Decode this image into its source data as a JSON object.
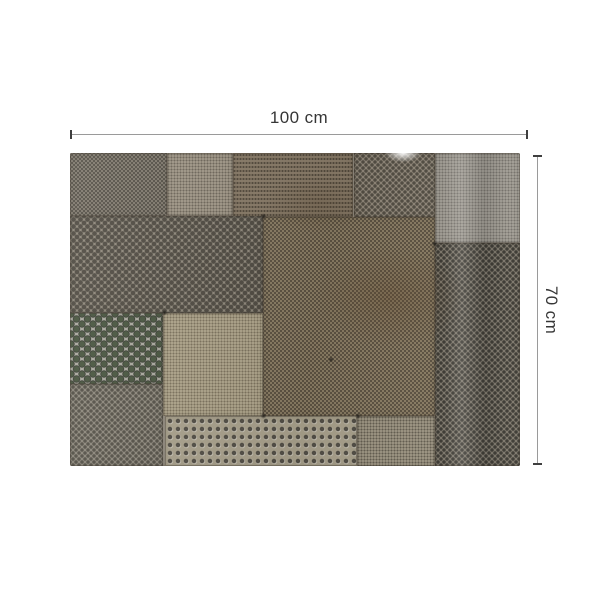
{
  "page": {
    "background_color": "#ffffff"
  },
  "dimension_annotations": {
    "width": {
      "label": "100 cm"
    },
    "height": {
      "label": "70 cm"
    },
    "line_color": "#9a9a9a",
    "tick_color": "#3f3f3f",
    "label_color": "#363636"
  },
  "photo": {
    "alt": "Top-down photo of a rectangular patchwork of weathered perforated metal sheets with assorted hole sizes and patterns in grey, tan and brown tones",
    "panels": [
      {
        "name": "panel-top-left-mesh",
        "x": 0,
        "y": 0,
        "w": 21.6,
        "h": 20.1,
        "base": "#8b8478",
        "dot": "rgba(42,39,33,0.55)",
        "pattern": "mesh"
      },
      {
        "name": "panel-top-tan-fine",
        "x": 21.6,
        "y": 0,
        "w": 14.7,
        "h": 20.1,
        "base": "#a69d8d",
        "dot": "rgba(55,50,42,0.50)",
        "pattern": "fine"
      },
      {
        "name": "panel-top-brown-dash",
        "x": 36.3,
        "y": 0,
        "w": 26.7,
        "h": 20.4,
        "base": "#8a7c69",
        "dot": "rgba(40,34,26,0.55)",
        "pattern": "dash"
      },
      {
        "name": "panel-top-polka",
        "x": 63.0,
        "y": 0,
        "w": 18.2,
        "h": 20.4,
        "base": "#92897b",
        "dot": "rgba(44,40,33,0.60)",
        "pattern": "med"
      },
      {
        "name": "panel-top-right-grey",
        "x": 81.2,
        "y": 0,
        "w": 18.8,
        "h": 28.8,
        "base": "#a7a39a",
        "dot": "rgba(60,58,52,0.45)",
        "pattern": "fine"
      },
      {
        "name": "panel-mid-left-coarse",
        "x": 0,
        "y": 20.1,
        "w": 42.9,
        "h": 31.0,
        "base": "#90897c",
        "dot": "rgba(38,35,29,0.60)",
        "pattern": "coarse"
      },
      {
        "name": "panel-center-mesh",
        "x": 42.9,
        "y": 20.4,
        "w": 38.2,
        "h": 63.6,
        "base": "#97886e",
        "dot": "rgba(43,37,28,0.55)",
        "pattern": "mesh"
      },
      {
        "name": "panel-right-dotted",
        "x": 81.2,
        "y": 28.8,
        "w": 18.8,
        "h": 71.2,
        "base": "#7e786c",
        "dot": "rgba(25,24,20,0.65)",
        "pattern": "med"
      },
      {
        "name": "panel-left-big-holes",
        "x": 0,
        "y": 51.1,
        "w": 20.7,
        "h": 22.7,
        "base": "#abaaa0",
        "dot": "rgba(44,48,38,0.92)",
        "pattern": "big"
      },
      {
        "name": "panel-bottom-left-fine",
        "x": 0,
        "y": 73.8,
        "w": 20.7,
        "h": 26.2,
        "base": "#8e897d",
        "dot": "rgba(40,37,31,0.55)",
        "pattern": "med"
      },
      {
        "name": "panel-mid-cream",
        "x": 20.7,
        "y": 51.1,
        "w": 22.2,
        "h": 32.9,
        "base": "#b4aa90",
        "dot": "rgba(70,60,44,0.50)",
        "pattern": "fine"
      },
      {
        "name": "panel-bottom-rows",
        "x": 21.0,
        "y": 84.0,
        "w": 42.8,
        "h": 16.0,
        "base": "#aba38e",
        "dot": "rgba(35,32,26,0.70)",
        "pattern": "rows"
      },
      {
        "name": "panel-bottom-fine",
        "x": 63.8,
        "y": 84.0,
        "w": 17.4,
        "h": 16.0,
        "base": "#a39b88",
        "dot": "rgba(48,44,36,0.55)",
        "pattern": "fine"
      }
    ]
  }
}
